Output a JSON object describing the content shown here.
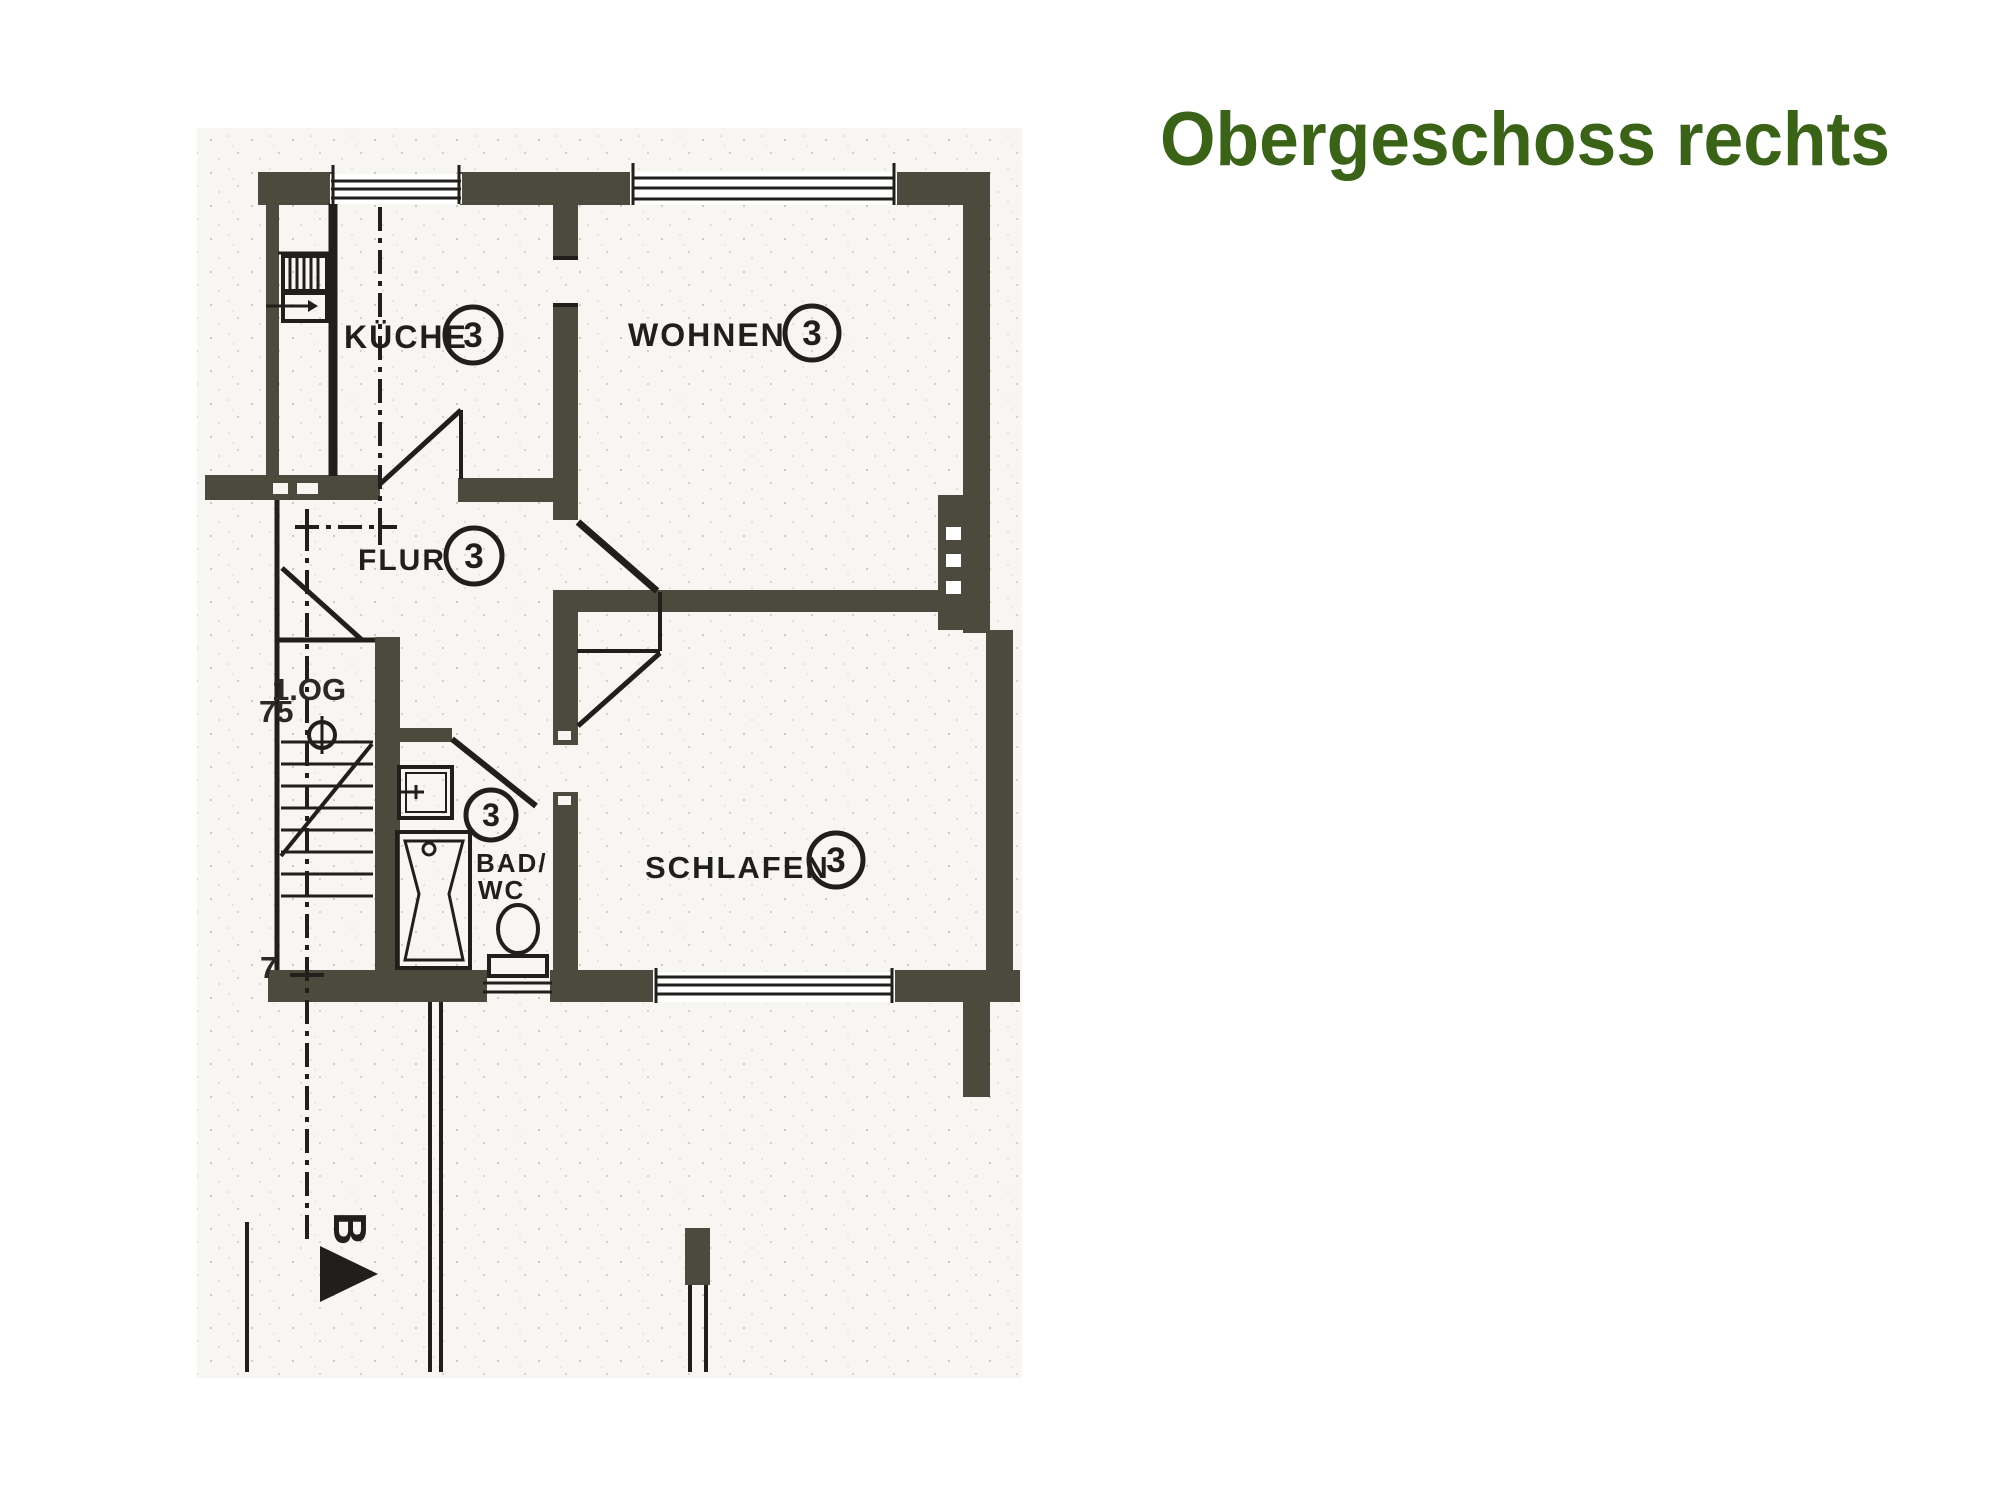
{
  "title": {
    "text": "Obergeschoss rechts",
    "color": "#3a6317"
  },
  "floor_plan": {
    "rooms": [
      {
        "name": "kueche",
        "label": "KÜCHE",
        "badge": "3"
      },
      {
        "name": "wohnen",
        "label": "WOHNEN",
        "badge": "3"
      },
      {
        "name": "flur",
        "label": "FLUR",
        "badge": "3"
      },
      {
        "name": "bad-wc",
        "label": "BAD/",
        "label_line2": "WC",
        "badge": "3"
      },
      {
        "name": "schlafen",
        "label": "SCHLAFEN",
        "badge": "3"
      }
    ],
    "annotations": {
      "floor_level": "1.OG",
      "dim_75": "75",
      "dim_7": "7",
      "section_letter": "B"
    },
    "colors": {
      "wall": "#4c4a3c",
      "line": "#201f1b",
      "title_green": "#3a6317"
    }
  }
}
